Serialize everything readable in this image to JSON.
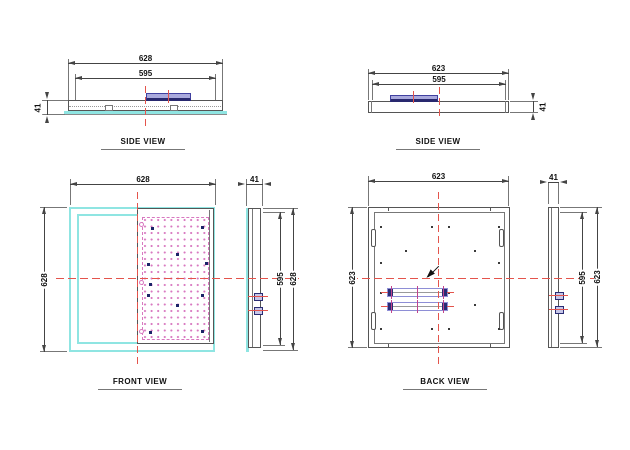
{
  "labels": {
    "side_view": "SIDE VIEW",
    "front_view": "FRONT VIEW",
    "back_view": "BACK VIEW"
  },
  "dimensions": {
    "side_left": {
      "outer_width": "628",
      "inner_width": "595",
      "thickness": "41"
    },
    "side_right": {
      "outer_width": "623",
      "inner_width": "595",
      "thickness": "41"
    },
    "front": {
      "width": "628",
      "height": "628",
      "profile_thickness": "41",
      "profile_inner": "595",
      "profile_outer": "628"
    },
    "back": {
      "width": "623",
      "height": "623",
      "profile_thickness": "41",
      "profile_inner": "595",
      "profile_outer": "623"
    }
  },
  "colors": {
    "frame_cyan": "#8fe5e2",
    "driver_fill": "#a9a9dd",
    "driver_border": "#4040a0",
    "navy": "#1c2468",
    "led_pink": "#d878c0",
    "centerline_red": "#e4544c"
  },
  "decor": {
    "front_navy_squares": [
      [
        151,
        227
      ],
      [
        201,
        226
      ],
      [
        176,
        253
      ],
      [
        147,
        263
      ],
      [
        205,
        262
      ],
      [
        149,
        283
      ],
      [
        147,
        294
      ],
      [
        201,
        294
      ],
      [
        176,
        304
      ],
      [
        149,
        331
      ],
      [
        201,
        330
      ]
    ],
    "back_holes": [
      [
        380,
        226
      ],
      [
        431,
        226
      ],
      [
        448,
        226
      ],
      [
        498,
        226
      ],
      [
        405,
        250
      ],
      [
        474,
        250
      ],
      [
        380,
        262
      ],
      [
        498,
        262
      ],
      [
        380,
        292
      ],
      [
        448,
        292
      ],
      [
        405,
        304
      ],
      [
        474,
        304
      ],
      [
        380,
        328
      ],
      [
        431,
        328
      ],
      [
        448,
        328
      ],
      [
        498,
        328
      ]
    ]
  }
}
